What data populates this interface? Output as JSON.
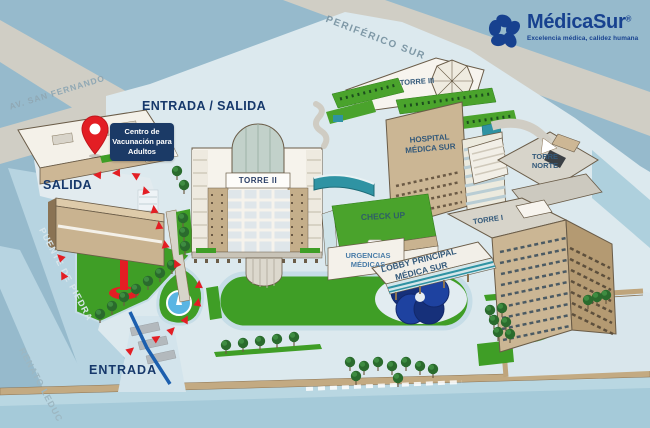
{
  "logo": {
    "name": "MédicaSur",
    "registered": "®",
    "tagline": "Excelencia médica, calidez humana"
  },
  "streets": {
    "periferico_sur": "PERIFÉRICO SUR",
    "av_san_fernando": "AV. SAN FERNANDO",
    "puente_de_piedra": "PUENTE DE PIEDRA",
    "renato_leduc": "RENATO LEDUC"
  },
  "access": {
    "entrada_salida": "ENTRADA / SALIDA",
    "salida": "SALIDA",
    "entrada": "ENTRADA"
  },
  "marker": {
    "label": "Centro de Vacunación para Adultos"
  },
  "buildings": {
    "torre_i": "TORRE I",
    "torre_ii": "TORRE II",
    "torre_iii": "TORRE III",
    "torre_norte": "TORRE NORTE",
    "hospital": "HOSPITAL MÉDICA SUR",
    "check_up": "CHECK UP",
    "urgencias": "URGENCIAS MÉDICAS",
    "lobby": "LOBBY PRINCIPAL MÉDICA SUR"
  },
  "colors": {
    "brand_blue": "#164193",
    "pin_red": "#E31E24",
    "lawn_green": "#3F9E26",
    "navy_label": "#1B3A66",
    "background": "#96BACC",
    "road_gray": "#D0CEC5",
    "road_blue": "#B7D4E1"
  }
}
